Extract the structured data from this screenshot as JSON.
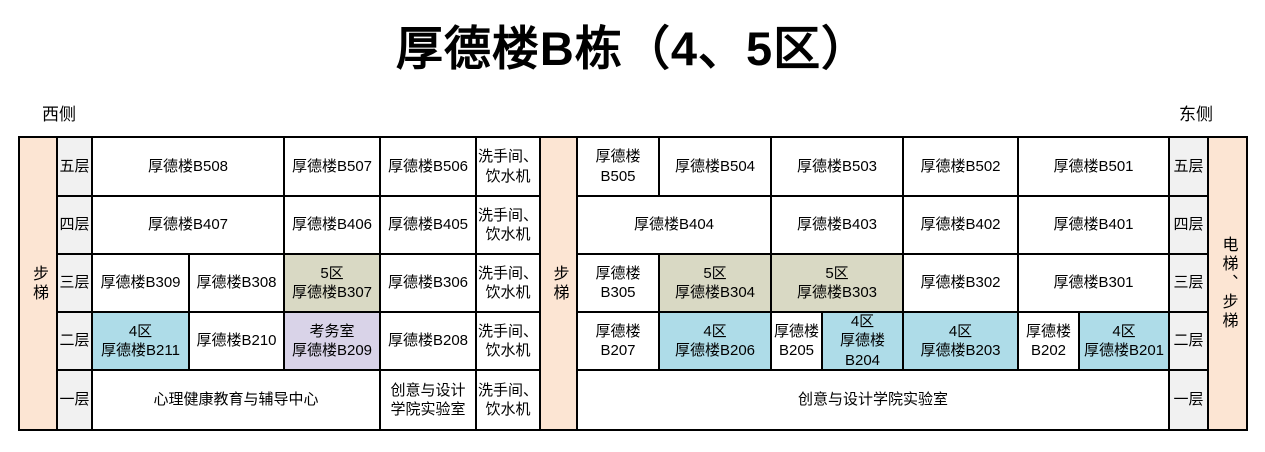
{
  "page": {
    "title": "厚德楼B栋（4、5区）"
  },
  "side_labels": {
    "west": "西侧",
    "east": "东侧"
  },
  "colors": {
    "stairs_bg": "#fce5d3",
    "floor_label_bg": "#f1f1f1",
    "zone5_bg": "#d9d9c4",
    "zone4_bg": "#aedce8",
    "exam_office_bg": "#d9d3e8",
    "border": "#000000"
  },
  "stairs": {
    "left": "步梯",
    "middle": "步梯",
    "right": "电梯、步梯"
  },
  "floors": {
    "f5": "五层",
    "f4": "四层",
    "f3": "三层",
    "f2": "二层",
    "f1": "一层"
  },
  "washroom": {
    "label": "洗手间、\n饮水机"
  },
  "rooms": {
    "b508": "厚德楼B508",
    "b507": "厚德楼B507",
    "b506": "厚德楼B506",
    "b505": "厚德楼B505",
    "b504": "厚德楼B504",
    "b503": "厚德楼B503",
    "b502": "厚德楼B502",
    "b501": "厚德楼B501",
    "b407": "厚德楼B407",
    "b406": "厚德楼B406",
    "b405": "厚德楼B405",
    "b404": "厚德楼B404",
    "b403": "厚德楼B403",
    "b402": "厚德楼B402",
    "b401": "厚德楼B401",
    "b309": "厚德楼B309",
    "b308": "厚德楼B308",
    "b307": "5区\n厚德楼B307",
    "b306": "厚德楼B306",
    "b305": "厚德楼B305",
    "b304": "5区\n厚德楼B304",
    "b303": "5区\n厚德楼B303",
    "b302": "厚德楼B302",
    "b301": "厚德楼B301",
    "b211": "4区\n厚德楼B211",
    "b210": "厚德楼B210",
    "b209": "考务室\n厚德楼B209",
    "b208": "厚德楼B208",
    "b207": "厚德楼B207",
    "b206": "4区\n厚德楼B206",
    "b205": "厚德楼\nB205",
    "b204": "4区\n厚德楼B204",
    "b203": "4区\n厚德楼B203",
    "b202": "厚德楼\nB202",
    "b201": "4区\n厚德楼B201",
    "counseling_center": "心理健康教育与辅导中心",
    "design_lab_left": "创意与设计\n学院实验室",
    "design_lab_right": "创意与设计学院实验室"
  }
}
